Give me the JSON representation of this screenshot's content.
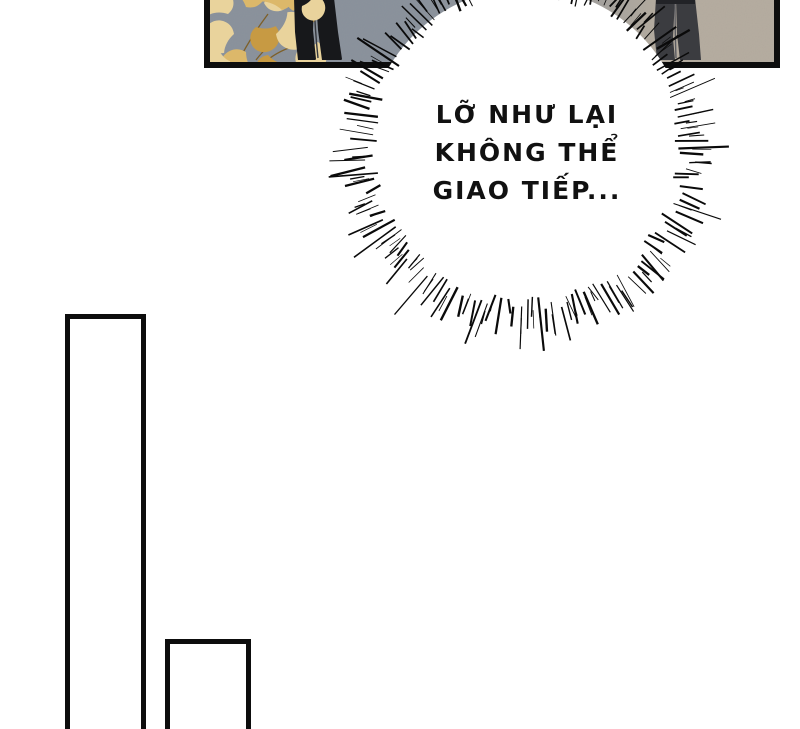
{
  "page": {
    "kind": "comic-page"
  },
  "speech_bubble": {
    "lines": [
      "LỠ NHƯ LẠI",
      "KHÔNG THỂ",
      "GIAO TIẾP..."
    ]
  },
  "colors": {
    "page_bg": "#ffffff",
    "panel_border": "#0d0d0d",
    "panel_bg_left": "#87909c",
    "panel_bg_mid": "#989a9c",
    "panel_bg_right": "#b6ada0",
    "leaves_light": "#e9d39c",
    "leaves_mid": "#dcb86a",
    "leaves_dark": "#c79a43",
    "stem": "#7d5f28",
    "figure_left": "#17181b",
    "figure_right": "#3b3c40",
    "bubble_fill": "#ffffff",
    "burst_stroke": "#0a0a0a",
    "text": "#111111"
  }
}
